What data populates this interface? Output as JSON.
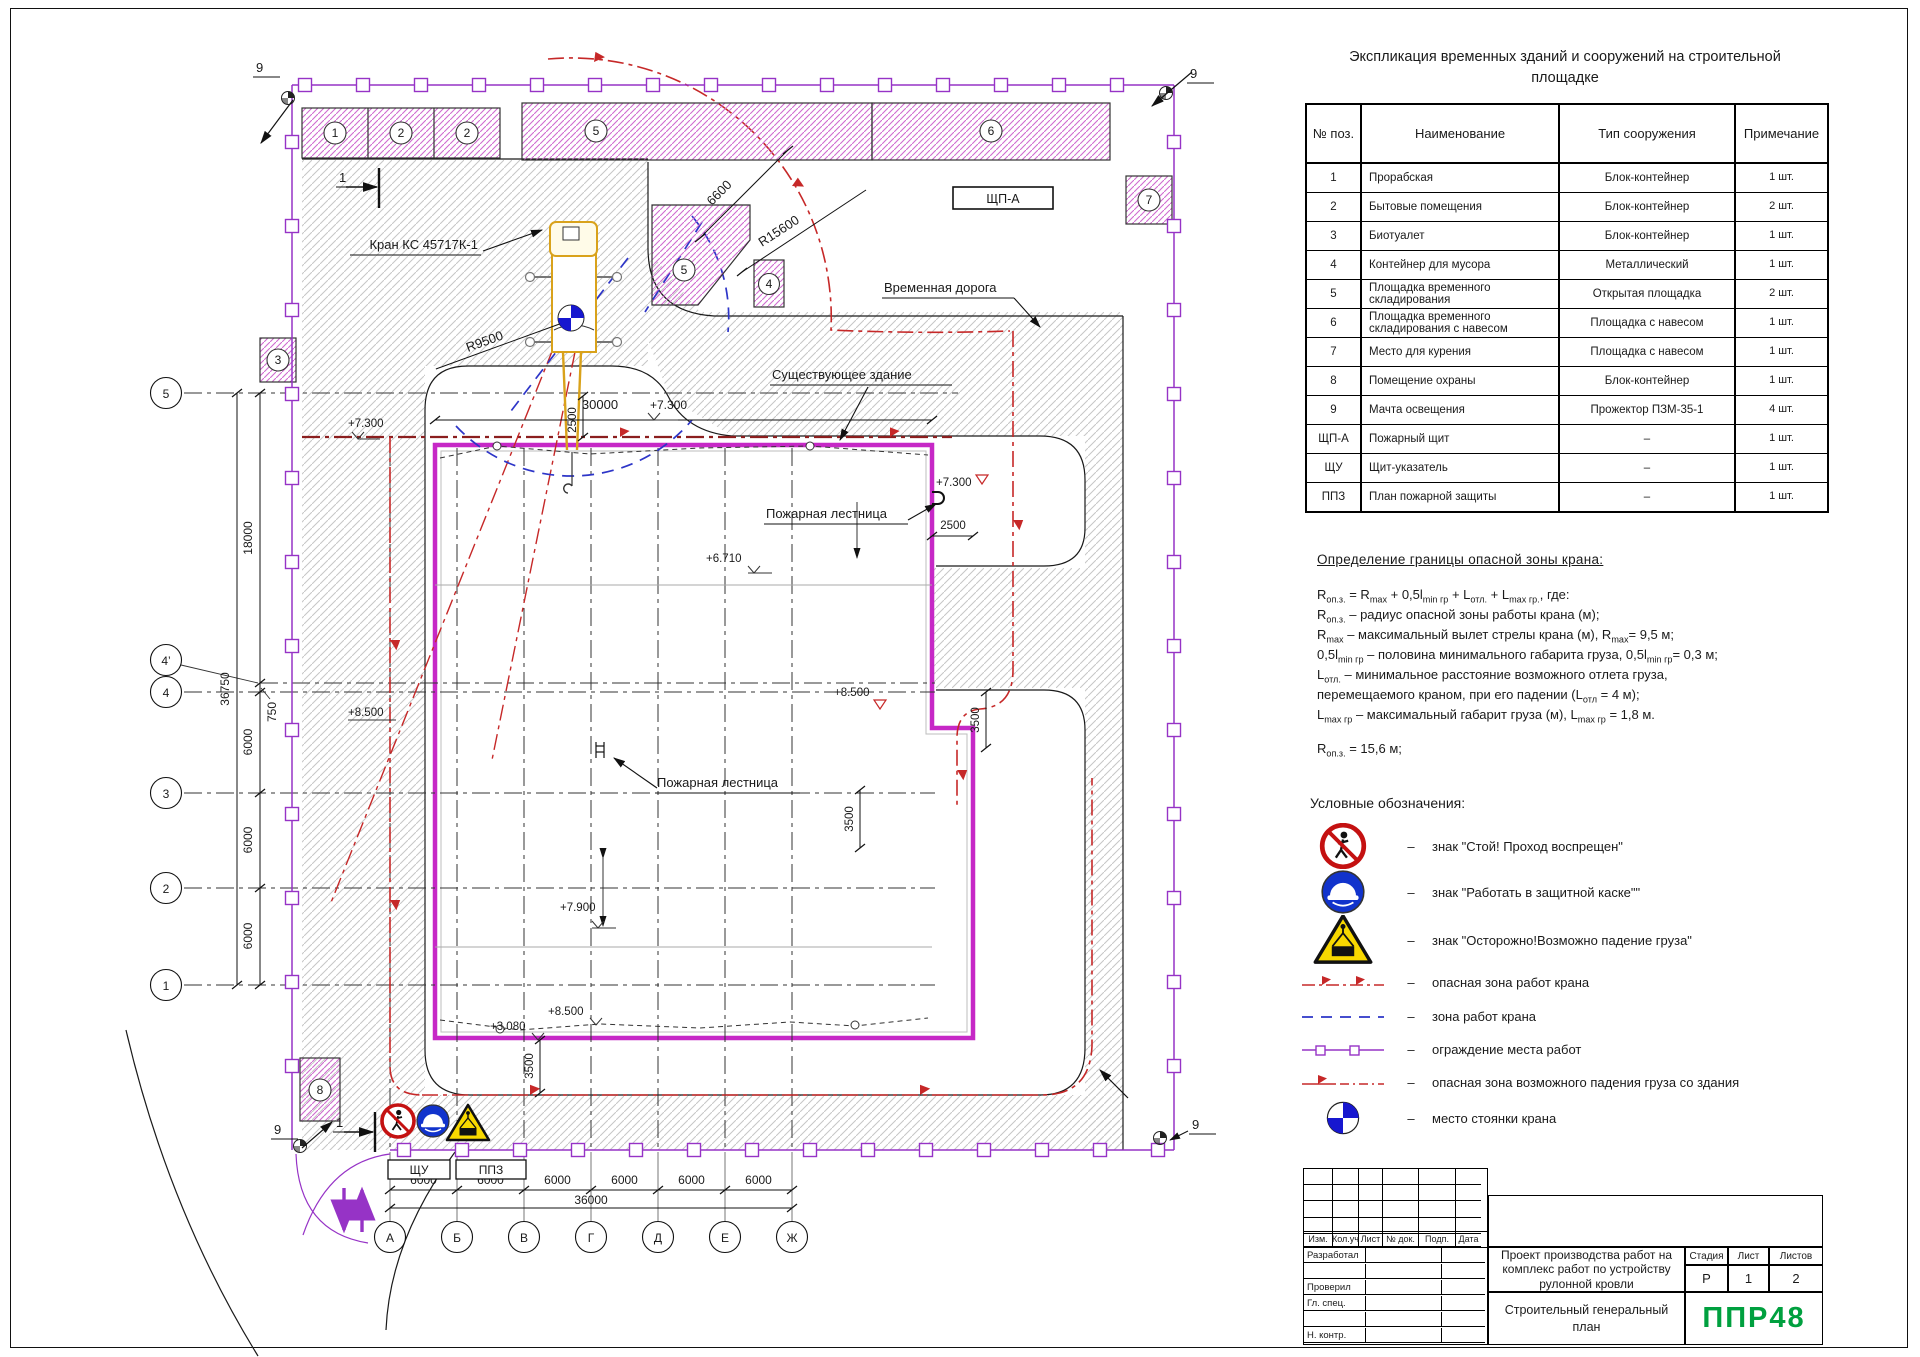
{
  "plan": {
    "labels": {
      "crane": "Кран КС 45717К-1",
      "temp_road": "Временная дорога",
      "existing_building": "Существующее здание",
      "fire_escape": "Пожарная лестница",
      "shpa": "ЩП-А",
      "shu": "ЩУ",
      "ppz": "ППЗ",
      "corner_mark": "9",
      "section_mark": "1"
    },
    "axes": {
      "bottom": [
        "А",
        "Б",
        "В",
        "Г",
        "Д",
        "Е",
        "Ж"
      ],
      "left": [
        "5",
        "4’",
        "4",
        "3",
        "2",
        "1"
      ]
    },
    "dims": {
      "d6600": "6600",
      "r15600": "R15600",
      "r9500": "R9500",
      "d30000": "30000",
      "d2500": "2500",
      "d18000": "18000",
      "d36750": "36750",
      "d750": "750",
      "d6000": "6000",
      "d36000": "36000",
      "d3500": "3500"
    },
    "levels": {
      "l7300": "+7.300",
      "l6710": "+6.710",
      "l7900": "+7.900",
      "l8500": "+8.500",
      "l3080": "+3.080"
    },
    "blocks": {
      "b1": "1",
      "b2": "2",
      "b3": "3",
      "b4": "4",
      "b5": "5",
      "b6": "6",
      "b7": "7",
      "b8": "8"
    }
  },
  "explication": {
    "title": "Экспликация временных зданий и сооружений на строительной площадке",
    "headers": [
      "№ поз.",
      "Наименование",
      "Тип сооружения",
      "Примечание"
    ],
    "rows": [
      [
        "1",
        "Прорабская",
        "Блок-контейнер",
        "1 шт."
      ],
      [
        "2",
        "Бытовые помещения",
        "Блок-контейнер",
        "2 шт."
      ],
      [
        "3",
        "Биотуалет",
        "Блок-контейнер",
        "1 шт."
      ],
      [
        "4",
        "Контейнер для мусора",
        "Металлический",
        "1 шт."
      ],
      [
        "5",
        "Площадка временного складирования",
        "Открытая площадка",
        "2 шт."
      ],
      [
        "6",
        "Площадка временного складирования с навесом",
        "Площадка с навесом",
        "1 шт."
      ],
      [
        "7",
        "Место для курения",
        "Площадка с навесом",
        "1 шт."
      ],
      [
        "8",
        "Помещение охраны",
        "Блок-контейнер",
        "1 шт."
      ],
      [
        "9",
        "Мачта освещения",
        "Прожектор ПЗМ-35-1",
        "4 шт."
      ],
      [
        "ЩП-А",
        "Пожарный щит",
        "–",
        "1 шт."
      ],
      [
        "ЩУ",
        "Щит-указатель",
        "–",
        "1 шт."
      ],
      [
        "ППЗ",
        "План пожарной защиты",
        "–",
        "1 шт."
      ]
    ]
  },
  "danger_zone": {
    "title": "Определение границы опасной зоны крана:",
    "lines": [
      "R_{оп.з.} = R_{max} + 0,5l_{min гр} + L_{отл.} + L_{max гр.}, где:",
      "R_{оп.з.} – радиус опасной зоны работы крана (м);",
      "R_{max} – максимальный вылет стрелы крана (м), R_{max}= 9,5 м;",
      "0,5l_{min гр} – половина минимального габарита груза, 0,5l_{min гр}= 0,3 м;",
      "L_{отл.} – минимальное расстояние возможного отлета груза,",
      "перемещаемого краном, при его падении (L_{отл} = 4 м);",
      "L_{max гр} – максимальный габарит груза (м), L_{max гр} = 1,8 м."
    ],
    "result": "R_{оп.з.} = 15,6 м;"
  },
  "legend": {
    "title": "Условные обозначения:",
    "dash": "–",
    "items": [
      "знак \"Стой! Проход воспрещен\"",
      "знак \"Работать в защитной каске\"\"",
      "знак \"Осторожно!Возможно падение груза\"",
      "опасная зона работ крана",
      "зона работ крана",
      "ограждение места работ",
      "опасная зона возможного падения груза со здания",
      "место стоянки крана"
    ]
  },
  "stamp": {
    "rev_cols": [
      "Изм.",
      "Кол.уч",
      "Лист",
      "№ док.",
      "Подп.",
      "Дата"
    ],
    "roles": [
      "Разработал",
      "",
      "Проверил",
      "Гл. спец.",
      "",
      "Н. контр."
    ],
    "project_title": [
      "Проект производства работ на",
      "комплекс работ по устройству",
      "рулонной кровли"
    ],
    "doc_title": [
      "Строительный генеральный",
      "план"
    ],
    "stage_label": "Стадия",
    "sheet_label": "Лист",
    "sheets_label": "Листов",
    "stage": "Р",
    "sheet_no": "1",
    "sheets_total": "2",
    "logo": "ППР48"
  }
}
